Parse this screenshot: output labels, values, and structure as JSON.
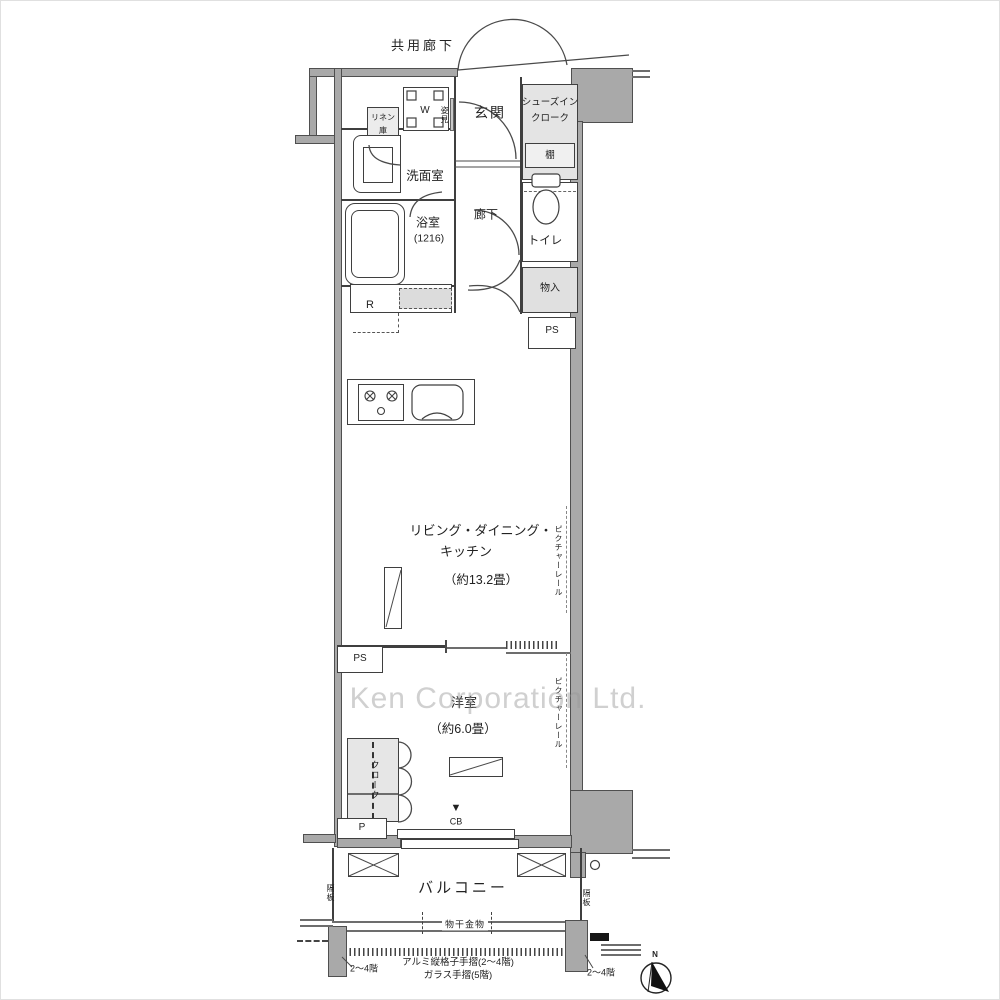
{
  "watermark": "Ken Corporation Ltd.",
  "outside": {
    "common_corridor": "共用廊下",
    "north": "N"
  },
  "entry": {
    "genkan": "玄関",
    "mirror": "姿見",
    "shoe_closet_l1": "シューズイン",
    "shoe_closet_l2": "クローク",
    "shelf": "棚"
  },
  "sanitary": {
    "washer": "W",
    "linen_l1": "リネン",
    "linen_l2": "庫",
    "washroom": "洗面室",
    "bathroom": "浴室",
    "bathroom_size": "(1216)",
    "hallway": "廊下",
    "toilet": "トイレ",
    "storage": "物入",
    "ps": "PS",
    "fridge": "R"
  },
  "ldk": {
    "name_l1": "リビング・ダイニング・",
    "name_l2": "キッチン",
    "size": "（約13.2畳）",
    "picture_rail": "ピクチャーレール",
    "ps": "PS"
  },
  "bedroom": {
    "name": "洋室",
    "size": "（約6.0畳）",
    "picture_rail": "ピクチャーレール",
    "closet": "クローク",
    "pipe": "P",
    "cb_arrow": "▼",
    "cb": "CB"
  },
  "balcony": {
    "name": "バルコニー",
    "partition_left": "隔板",
    "partition_right": "隔板",
    "laundry_fitting": "物干金物",
    "handrail_note1": "アルミ縦格子手摺(2〜4階)",
    "handrail_note2": "ガラス手摺(5階)",
    "floors_left": "2〜4階",
    "floors_right": "2〜4階"
  }
}
